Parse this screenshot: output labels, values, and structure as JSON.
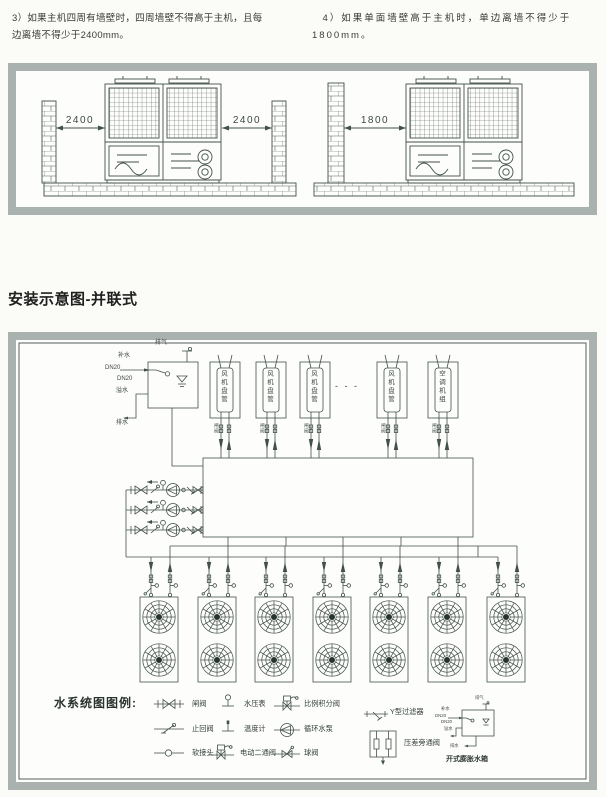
{
  "page": {
    "note3": "3）如果主机四周有墙壁时，四周墙壁不得高于主机，且每边离墙不得少于2400mm。",
    "note4": "4）如果单面墙壁高于主机时，单边离墙不得少于1800mm。",
    "section_heading": "安装示意图-并联式"
  },
  "clearance": {
    "four_wall": {
      "dim_left": "2400",
      "dim_right": "2400"
    },
    "single_wall": {
      "dim": "1800"
    }
  },
  "schematic": {
    "tank": {
      "vent": "排气",
      "makeup": "补水",
      "dn_top": "DN20",
      "dn_bottom": "DN20",
      "overflow": "溢水",
      "drain": "排水"
    },
    "units": [
      {
        "label": "风机盘管"
      },
      {
        "label": "风机盘管"
      },
      {
        "label": "风机盘管"
      },
      {
        "label": "风机盘管"
      },
      {
        "label": "空调机组"
      }
    ],
    "branch_valve_label": "闸阀",
    "ellipsis": "- - -",
    "chiller_count": 7,
    "legend": {
      "title": "水系统图图例:",
      "items": [
        "闸阀",
        "止回阀",
        "软接头",
        "水压表",
        "温度计",
        "电动二通阀",
        "比例积分阀",
        "循环水泵",
        "球阀",
        "Y型过滤器",
        "压差旁通阀"
      ],
      "expansion_tank": {
        "caption": "开式膨胀水箱",
        "vent": "排气",
        "makeup": "补水",
        "dn_top": "DN20",
        "dn_bottom": "DN20",
        "overflow": "溢水",
        "drain": "排水"
      }
    }
  },
  "colors": {
    "frame": "#a9b2ae",
    "ink": "#42504b",
    "text": "#333333",
    "paper": "#fbfbf7"
  }
}
